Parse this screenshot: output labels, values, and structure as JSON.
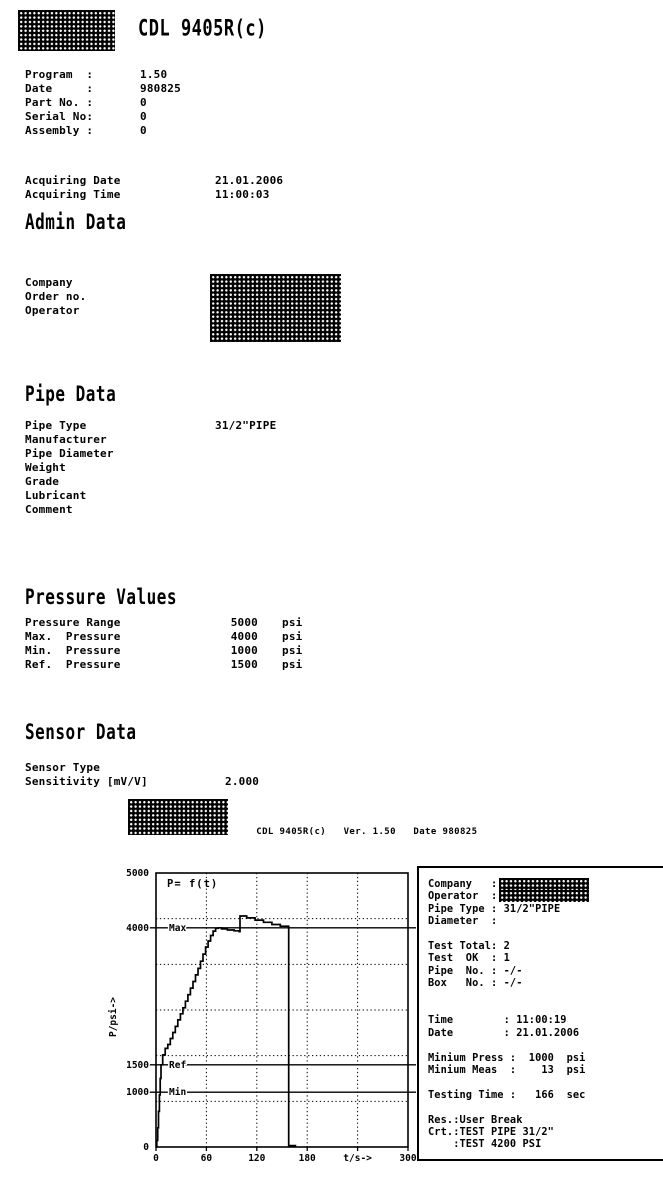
{
  "header": {
    "title": "CDL 9405R(c)"
  },
  "program": {
    "rows": [
      {
        "label": "Program  :",
        "value": "1.50"
      },
      {
        "label": "Date     :",
        "value": "980825"
      },
      {
        "label": "Part No. :",
        "value": "0"
      },
      {
        "label": "Serial No:",
        "value": "0"
      },
      {
        "label": "Assembly :",
        "value": "0"
      }
    ]
  },
  "acquiring": {
    "rows": [
      {
        "label": "Acquiring Date",
        "value": "21.01.2006"
      },
      {
        "label": "Acquiring Time",
        "value": "11:00:03"
      }
    ]
  },
  "admin": {
    "heading": "Admin Data",
    "rows": [
      {
        "label": "Company"
      },
      {
        "label": "Order no."
      },
      {
        "label": "Operator"
      }
    ]
  },
  "pipe": {
    "heading": "Pipe Data",
    "rows": [
      {
        "label": "Pipe Type",
        "value": "31/2\"PIPE"
      },
      {
        "label": "Manufacturer",
        "value": ""
      },
      {
        "label": "Pipe Diameter",
        "value": ""
      },
      {
        "label": "Weight",
        "value": ""
      },
      {
        "label": "Grade",
        "value": ""
      },
      {
        "label": "Lubricant",
        "value": ""
      },
      {
        "label": "Comment",
        "value": ""
      }
    ]
  },
  "pressure": {
    "heading": "Pressure Values",
    "rows": [
      {
        "label": "Pressure Range",
        "value": "5000",
        "unit": "psi"
      },
      {
        "label": "Max.  Pressure",
        "value": "4000",
        "unit": "psi"
      },
      {
        "label": "Min.  Pressure",
        "value": "1000",
        "unit": "psi"
      },
      {
        "label": "Ref.  Pressure",
        "value": "1500",
        "unit": "psi"
      }
    ]
  },
  "sensor": {
    "heading": "Sensor Data",
    "rows": [
      {
        "label": "Sensor Type",
        "value": ""
      },
      {
        "label": "Sensitivity [mV/V]",
        "value": "2.000"
      }
    ]
  },
  "subheader": {
    "title": "CDL 9405R(c)",
    "version": "Ver. 1.50",
    "date": "Date 980825"
  },
  "chart_data": {
    "type": "line",
    "title": "P= f(t)",
    "xlabel": "t/s->",
    "ylabel": "P/psi->",
    "xlim": [
      0,
      300
    ],
    "ylim": [
      0,
      5000
    ],
    "x_grid_step": 60,
    "y_grid_divisions": 6,
    "grid": "dotted",
    "x_ticks": [
      {
        "value": 0,
        "label": "0"
      },
      {
        "value": 60,
        "label": "60"
      },
      {
        "value": 120,
        "label": "120"
      },
      {
        "value": 180,
        "label": "180"
      },
      {
        "value": 300,
        "label": "300"
      }
    ],
    "xlabel_at": 240,
    "y_ticks": [
      {
        "value": 5000,
        "label": "5000"
      },
      {
        "value": 4000,
        "label": "4000"
      },
      {
        "value": 1500,
        "label": "1500"
      },
      {
        "value": 1000,
        "label": "1000"
      },
      {
        "value": 0,
        "label": "0"
      }
    ],
    "reference_lines": [
      {
        "label": "Max",
        "value": 4000
      },
      {
        "label": "Ref",
        "value": 1500
      },
      {
        "label": "Min",
        "value": 1000
      }
    ],
    "series": [
      {
        "name": "P = f(t)",
        "points": [
          [
            0,
            0
          ],
          [
            1,
            120
          ],
          [
            2,
            350
          ],
          [
            3,
            650
          ],
          [
            4,
            950
          ],
          [
            5,
            1250
          ],
          [
            6,
            1500
          ],
          [
            8,
            1680
          ],
          [
            11,
            1800
          ],
          [
            14,
            1870
          ],
          [
            17,
            1980
          ],
          [
            20,
            2090
          ],
          [
            23,
            2200
          ],
          [
            26,
            2320
          ],
          [
            29,
            2430
          ],
          [
            32,
            2540
          ],
          [
            35,
            2660
          ],
          [
            38,
            2780
          ],
          [
            41,
            2900
          ],
          [
            44,
            3020
          ],
          [
            47,
            3140
          ],
          [
            50,
            3260
          ],
          [
            53,
            3390
          ],
          [
            56,
            3520
          ],
          [
            59,
            3650
          ],
          [
            62,
            3760
          ],
          [
            65,
            3860
          ],
          [
            68,
            3940
          ],
          [
            71,
            3990
          ],
          [
            74,
            4000
          ],
          [
            78,
            3980
          ],
          [
            85,
            3960
          ],
          [
            93,
            3945
          ],
          [
            99,
            3930
          ],
          [
            100,
            4215
          ],
          [
            108,
            4180
          ],
          [
            118,
            4140
          ],
          [
            128,
            4100
          ],
          [
            138,
            4060
          ],
          [
            148,
            4030
          ],
          [
            158,
            4020
          ],
          [
            158,
            25
          ],
          [
            166,
            10
          ]
        ]
      }
    ]
  },
  "result_panel": {
    "lines": [
      {
        "text": "Company   :",
        "redacted": true
      },
      {
        "text": "Operator  :",
        "redacted": true
      },
      {
        "text": "Pipe Type : 31/2\"PIPE"
      },
      {
        "text": "Diameter  :"
      },
      {
        "text": ""
      },
      {
        "text": "Test Total: 2"
      },
      {
        "text": "Test  OK  : 1"
      },
      {
        "text": "Pipe  No. : -/-"
      },
      {
        "text": "Box   No. : -/-"
      },
      {
        "text": ""
      },
      {
        "text": ""
      },
      {
        "text": "Time        : 11:00:19"
      },
      {
        "text": "Date        : 21.01.2006"
      },
      {
        "text": ""
      },
      {
        "text": "Minium Press :  1000  psi"
      },
      {
        "text": "Minium Meas  :    13  psi"
      },
      {
        "text": ""
      },
      {
        "text": "Testing Time :   166  sec"
      },
      {
        "text": ""
      },
      {
        "text": "Res.:User Break"
      },
      {
        "text": "Crt.:TEST PIPE 31/2\""
      },
      {
        "text": "    :TEST 4200 PSI"
      }
    ]
  }
}
